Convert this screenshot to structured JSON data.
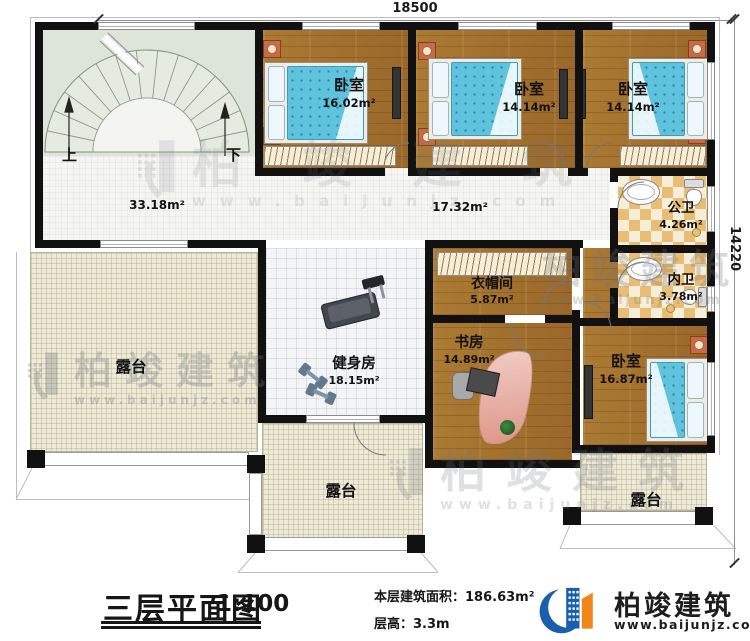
{
  "dimensions": {
    "width": "18500",
    "height": "14220"
  },
  "stairwell": {
    "up": "上",
    "down": "下"
  },
  "areas": {
    "hall": "33.18m²",
    "corridor": "17.32m²"
  },
  "rooms": {
    "bedroom1": {
      "label": "卧室",
      "area": "16.02m²"
    },
    "bedroom2": {
      "label": "卧室",
      "area": "14.14m²"
    },
    "bedroom3": {
      "label": "卧室",
      "area": "14.14m²"
    },
    "public_bath": {
      "label": "公卫",
      "area": "4.26m²"
    },
    "inner_bath": {
      "label": "内卫",
      "area": "3.78m²"
    },
    "cloakroom": {
      "label": "衣帽间",
      "area": "5.87m²"
    },
    "study": {
      "label": "书房",
      "area": "14.89m²"
    },
    "bedroom4": {
      "label": "卧室",
      "area": "16.87m²"
    },
    "gym": {
      "label": "健身房",
      "area": "18.15m²"
    }
  },
  "terraces": {
    "left": "露台",
    "bottom": "露台",
    "right": "露台"
  },
  "title_block": {
    "title": "三层平面图",
    "scale": "1:100",
    "building_area_label": "本层建筑面积：",
    "building_area_value": "186.63m²",
    "floor_height_label": "层高：",
    "floor_height_value": "3.3m"
  },
  "brand": {
    "name": "柏竣建筑",
    "website": "www.baijunjz.com"
  },
  "watermark": {
    "name": "柏竣建筑",
    "website": "www.baijunjz.com"
  },
  "colors": {
    "wall": "#111111",
    "wood_floor": "#a8752f",
    "bath_tile": "#e9bd74",
    "terrace_floor": "#edeada",
    "stair_floor": "#e0e7dc",
    "mattress": "#5fc3de",
    "brand_blue": "#1a5fae",
    "brand_orange": "#f08519"
  }
}
